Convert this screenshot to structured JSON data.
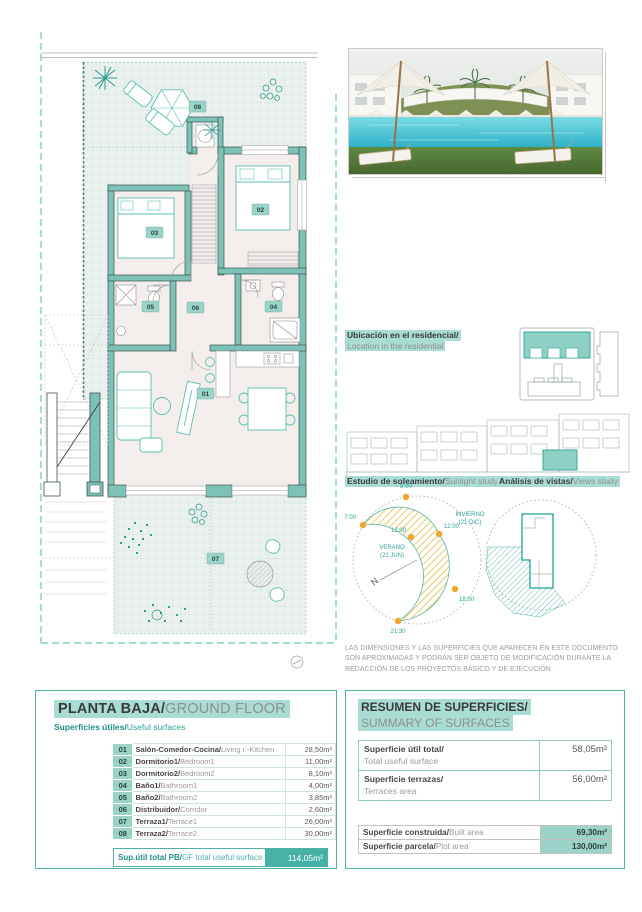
{
  "page": {
    "accent": "#2ba196"
  },
  "photo": {
    "label": "residential pool render"
  },
  "location": {
    "title_es": "Ubicación en el residencial/",
    "title_en": "Location in the residential"
  },
  "sun_study": {
    "title_es": "Estudio de soleamiento/",
    "title_en": "Sunlight study",
    "t_0800": "8:00",
    "t_0700": "7:00",
    "t_1200_summer": "12:00",
    "summer_line1": "VERANO",
    "summer_line2": "(21 JUN)",
    "t_1200_winter": "12:00",
    "winter_line1": "INVIERNO",
    "winter_line2": "(21 DIC)",
    "t_1800": "18:00",
    "t_2130": "21:30",
    "north": "N"
  },
  "views_study": {
    "title_es": "Análisis de vistas/",
    "title_en": "Views study"
  },
  "disclaimer": "LAS DIMENSIONES Y LAS SUPERFICIES QUE APARECEN EN ESTE DOCUMENTO SON APROXIMADAS Y PODRÁN SER OBJETO DE MODIFICACIÓN DURANTE LA REDACCIÓN DE LOS PROYECTOS BÁSICO Y DE EJECUCIÓN.",
  "plan": {
    "labels": [
      "01",
      "02",
      "03",
      "04",
      "05",
      "06",
      "07",
      "08"
    ]
  },
  "ground_floor": {
    "title_es": "PLANTA BAJA/",
    "title_en": "GROUND FLOOR",
    "subtitle_es": "Superficies útiles/",
    "subtitle_en": "Useful surfaces",
    "rows": [
      {
        "num": "01",
        "es": "Salón-Comedor-Cocina/",
        "en": "Living r.-Kitchen",
        "value": "28,50m²"
      },
      {
        "num": "02",
        "es": "Dormitorio1/",
        "en": "Bedroom1",
        "value": "11,00m²"
      },
      {
        "num": "03",
        "es": "Dormitorio2/",
        "en": "Bedroom2",
        "value": "8,10m²"
      },
      {
        "num": "04",
        "es": "Baño1/",
        "en": "Bathroom1",
        "value": "4,00m²"
      },
      {
        "num": "05",
        "es": "Baño2/",
        "en": "Bathroom2",
        "value": "3,85m²"
      },
      {
        "num": "06",
        "es": "Distribuidor/",
        "en": "Corridor",
        "value": "2,60m²"
      },
      {
        "num": "07",
        "es": "Terraza1/",
        "en": "Terrace1",
        "value": "26,00m²"
      },
      {
        "num": "08",
        "es": "Terraza2/",
        "en": "Terrace2",
        "value": "30,00m²"
      }
    ],
    "total_es": "Sup.útil total PB/",
    "total_en": "GF total useful surface",
    "total_value": "114,05m²"
  },
  "summary": {
    "title_es": "RESUMEN DE SUPERFICIES/",
    "title_en": "SUMMARY OF SURFACES",
    "useful": {
      "es": "Superficie útil total/",
      "en": "Total useful surface",
      "value": "58,05m²"
    },
    "terraces": {
      "es": "Superficie terrazas/",
      "en": "Terraces area",
      "value": "56,00m²"
    },
    "built": {
      "es": "Superficie construida/",
      "en": "Built area",
      "value": "69,30m²"
    },
    "plot": {
      "es": "Superficie parcela/",
      "en": "Plot area",
      "value": "130,00m²"
    }
  }
}
